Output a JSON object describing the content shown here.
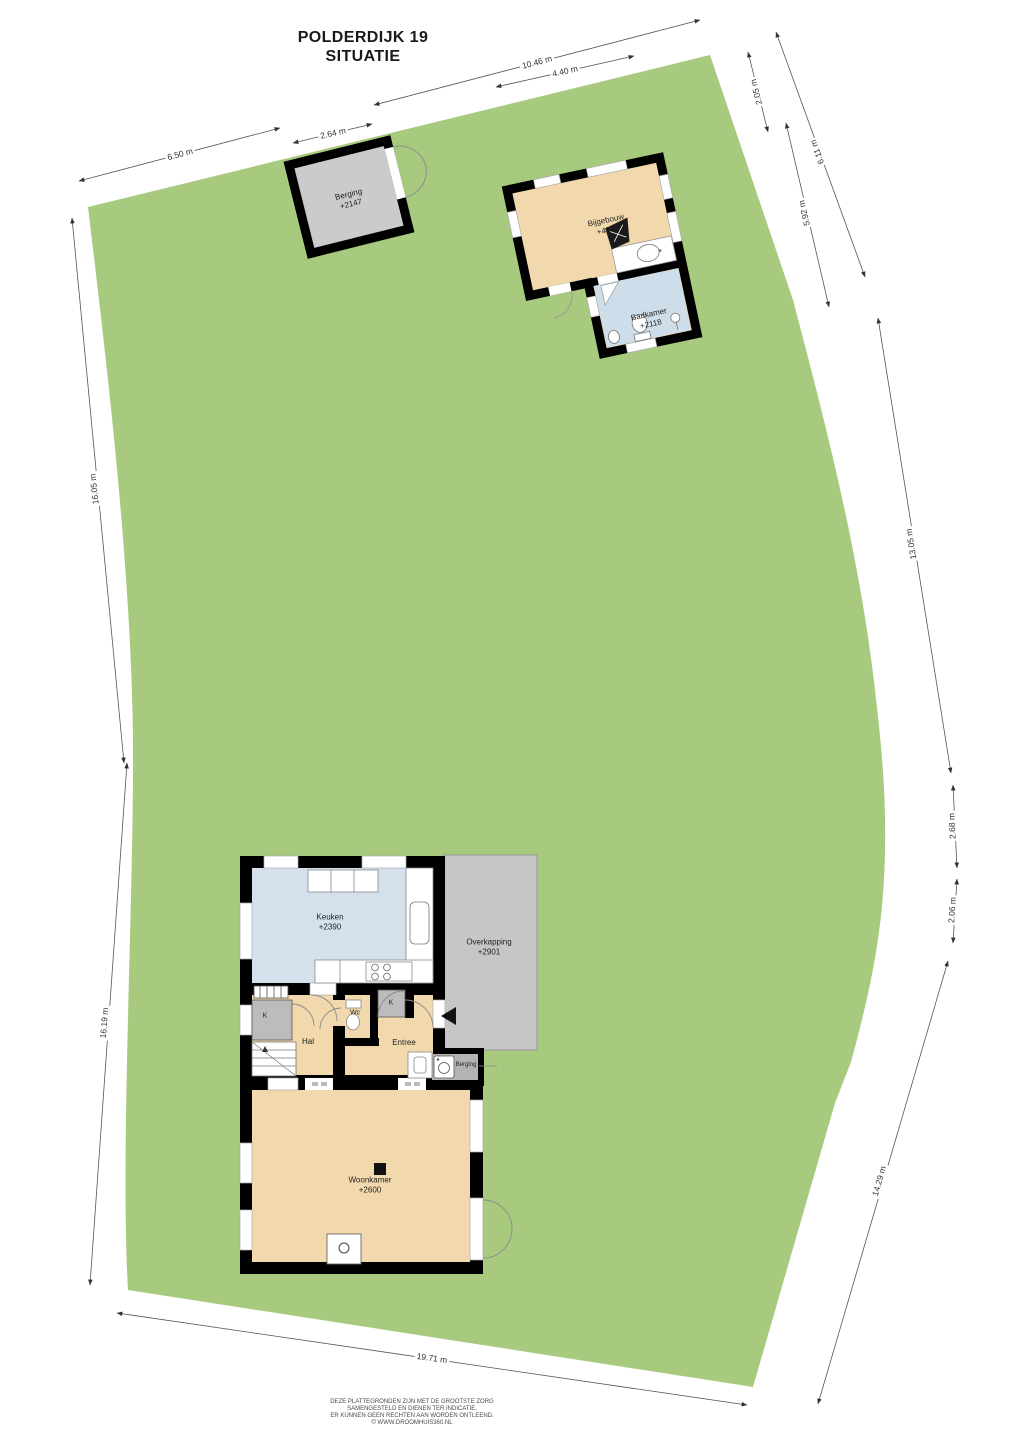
{
  "title": {
    "line1": "POLDERDIJK 19",
    "line2": "SITUATIE"
  },
  "rooms": {
    "berging_shed": {
      "name": "Berging",
      "level": "+2147"
    },
    "bijgebouw": {
      "name": "Bijgebouw",
      "level": "+4264"
    },
    "badkamer": {
      "name": "Badkamer",
      "level": "+2118"
    },
    "keuken": {
      "name": "Keuken",
      "level": "+2390"
    },
    "overkapping": {
      "name": "Overkapping",
      "level": "+2901"
    },
    "hal": {
      "name": "Hal"
    },
    "wc": {
      "name": "Wc"
    },
    "entree": {
      "name": "Entree"
    },
    "kast1": {
      "name": "K"
    },
    "kast2": {
      "name": "K"
    },
    "berging_intern": {
      "name": "Berging"
    },
    "woonkamer": {
      "name": "Woonkamer",
      "level": "+2600"
    }
  },
  "dimensions": [
    {
      "label": "6.50 m"
    },
    {
      "label": "2.64 m"
    },
    {
      "label": "10.46 m"
    },
    {
      "label": "4.40 m"
    },
    {
      "label": "2.05 m"
    },
    {
      "label": "6.11 m"
    },
    {
      "label": "5.92 m"
    },
    {
      "label": "13.05 m"
    },
    {
      "label": "2.68 m"
    },
    {
      "label": "2.06 m"
    },
    {
      "label": "14.29 m"
    },
    {
      "label": "19.71 m"
    },
    {
      "label": "16.05 m"
    },
    {
      "label": "16.19 m"
    }
  ],
  "footer": {
    "line1": "DEZE PLATTEGRONDEN ZIJN MET DE GROOTSTE ZORG",
    "line2": "SAMENGESTELD EN DIENEN TER INDICATIE.",
    "line3": "ER KUNNEN GEEN RECHTEN AAN WORDEN ONTLEEND.",
    "line4": "© WWW.DROOMHUIS360.NL"
  },
  "colors": {
    "plot_green": "#a7ca7f",
    "room_tan": "#f2d9ad",
    "kitchen_blue": "#d4e1ed",
    "wet_blue": "#cdddea",
    "shed_gray": "#cbcbcb",
    "closet_gray": "#bcbcbc",
    "canopy_gray": "#c6c6c6",
    "wall_black": "#000000"
  }
}
